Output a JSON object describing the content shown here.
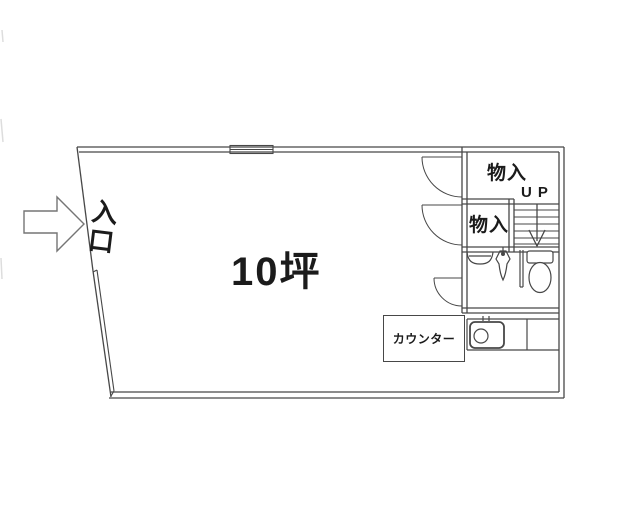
{
  "labels": {
    "area": "10坪",
    "entrance": "入口",
    "storage_upper": "物入",
    "storage_lower": "物入",
    "stairs_direction": "UP",
    "counter": "カウンター"
  },
  "colors": {
    "wall": "#474747",
    "text": "#1b1b1b",
    "arrow": "#757575",
    "background": "#ffffff"
  }
}
